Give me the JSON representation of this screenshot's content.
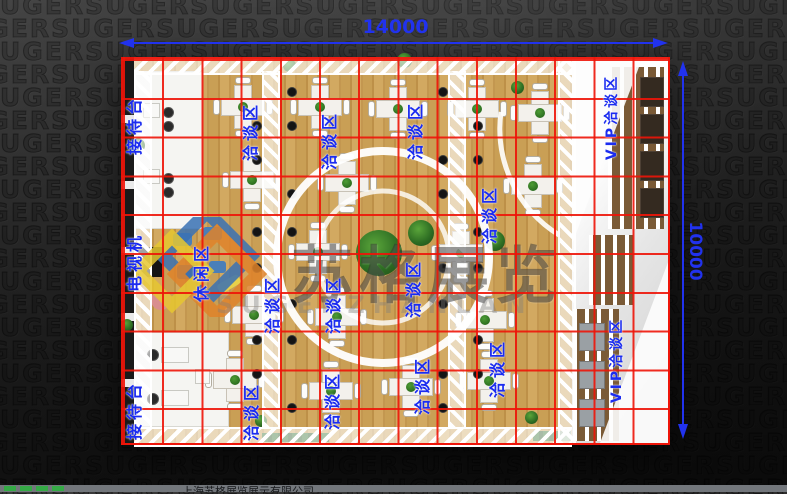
{
  "dimensions": {
    "top": "14000",
    "right": "10000"
  },
  "labels": {
    "reception": "接待台",
    "tv": "电视机",
    "leisure": "休闲区",
    "meeting": "洽谈区",
    "vip": "VIP洽谈区"
  },
  "watermark": {
    "cn": "苏格展览",
    "en": "SUGERZHANLAN"
  },
  "background": {
    "pattern_word": "SUGER"
  },
  "bottom_bar": {
    "company": "上海苏格展览展示有限公司"
  },
  "colors": {
    "dimension_blue": "#2132ee",
    "label_blue": "#1b2cf0",
    "grid_red": "#ee1408",
    "wood_floor": "#c9a057",
    "vip_floor": "#ededed",
    "truss_white": "#ffffff"
  }
}
